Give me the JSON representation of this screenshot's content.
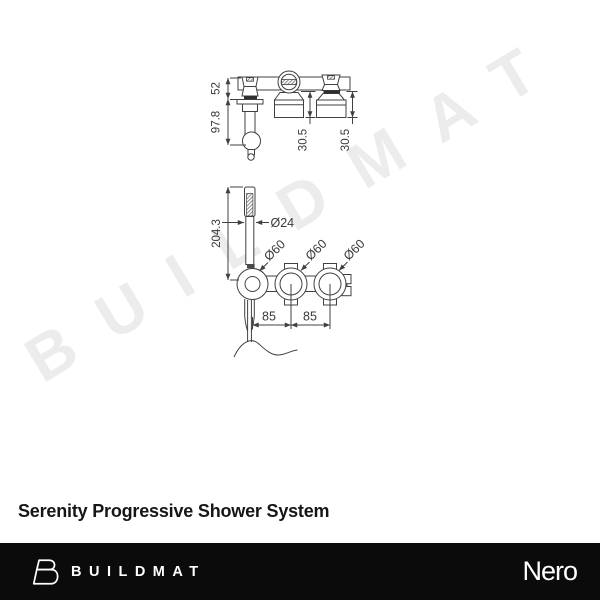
{
  "watermark": {
    "text": "BUILDMAT",
    "color": "#ececec"
  },
  "product": {
    "title": "Serenity Progressive Shower System"
  },
  "drawing": {
    "stroke_color": "#404040",
    "label_color": "#3a3a3a",
    "top_view": {
      "dim_52": "52",
      "dim_97_8": "97.8",
      "dim_30_5_mid": "30.5",
      "dim_30_5_right": "30.5"
    },
    "front_view": {
      "dim_204_3": "204.3",
      "dim_d24": "Ø24",
      "dim_d60_1": "Ø60",
      "dim_d60_2": "Ø60",
      "dim_d60_3": "Ø60",
      "dim_85_1": "85",
      "dim_85_2": "85"
    }
  },
  "footer": {
    "background": "#0b0b0b",
    "brand_icon": "buildmat-logo-icon",
    "brand_wordmark": "BUILDMAT",
    "partner_logo": "Nero"
  }
}
